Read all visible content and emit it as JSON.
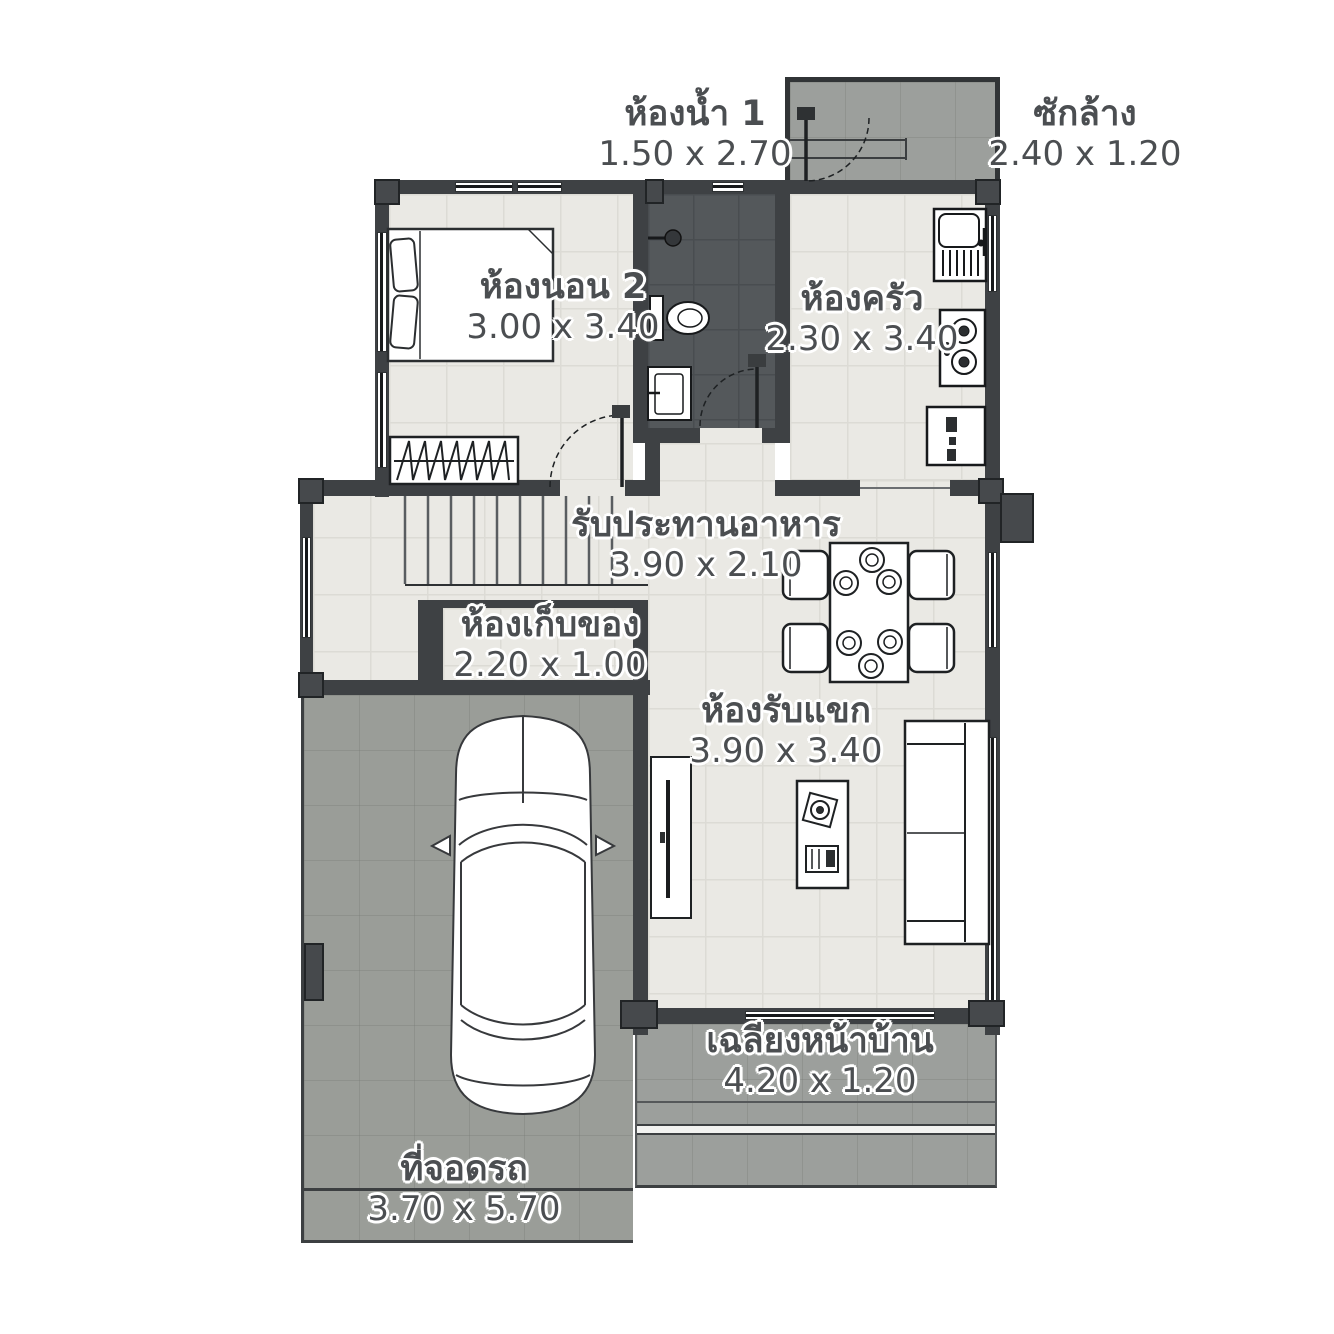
{
  "plan_title": "single-storey house floor plan",
  "palette": {
    "wall": "#3e4144",
    "floor_light": "#eae9e4",
    "floor_grid": "#dcdbd5",
    "bathroom_floor": "#54585b",
    "outdoor_gray": "#9c9f9c",
    "furniture_stroke": "#2b2e30",
    "label_text": "#4b4e51",
    "label_halo": "#ffffff"
  },
  "rooms": [
    {
      "id": "bathroom1",
      "name": "ห้องน้ำ 1",
      "dims": "1.50 x 2.70"
    },
    {
      "id": "laundry",
      "name": "ซักล้าง",
      "dims": "2.40 x 1.20"
    },
    {
      "id": "bedroom2",
      "name": "ห้องนอน 2",
      "dims": "3.00 x 3.40"
    },
    {
      "id": "kitchen",
      "name": "ห้องครัว",
      "dims": "2.30 x 3.40"
    },
    {
      "id": "dining",
      "name": "รับประทานอาหาร",
      "dims": "3.90 x 2.10"
    },
    {
      "id": "storage",
      "name": "ห้องเก็บของ",
      "dims": "2.20 x 1.00"
    },
    {
      "id": "living",
      "name": "ห้องรับแขก",
      "dims": "3.90 x 3.40"
    },
    {
      "id": "porch",
      "name": "เฉลียงหน้าบ้าน",
      "dims": "4.20 x 1.20"
    },
    {
      "id": "parking",
      "name": "ที่จอดรถ",
      "dims": "3.70 x 5.70"
    }
  ]
}
